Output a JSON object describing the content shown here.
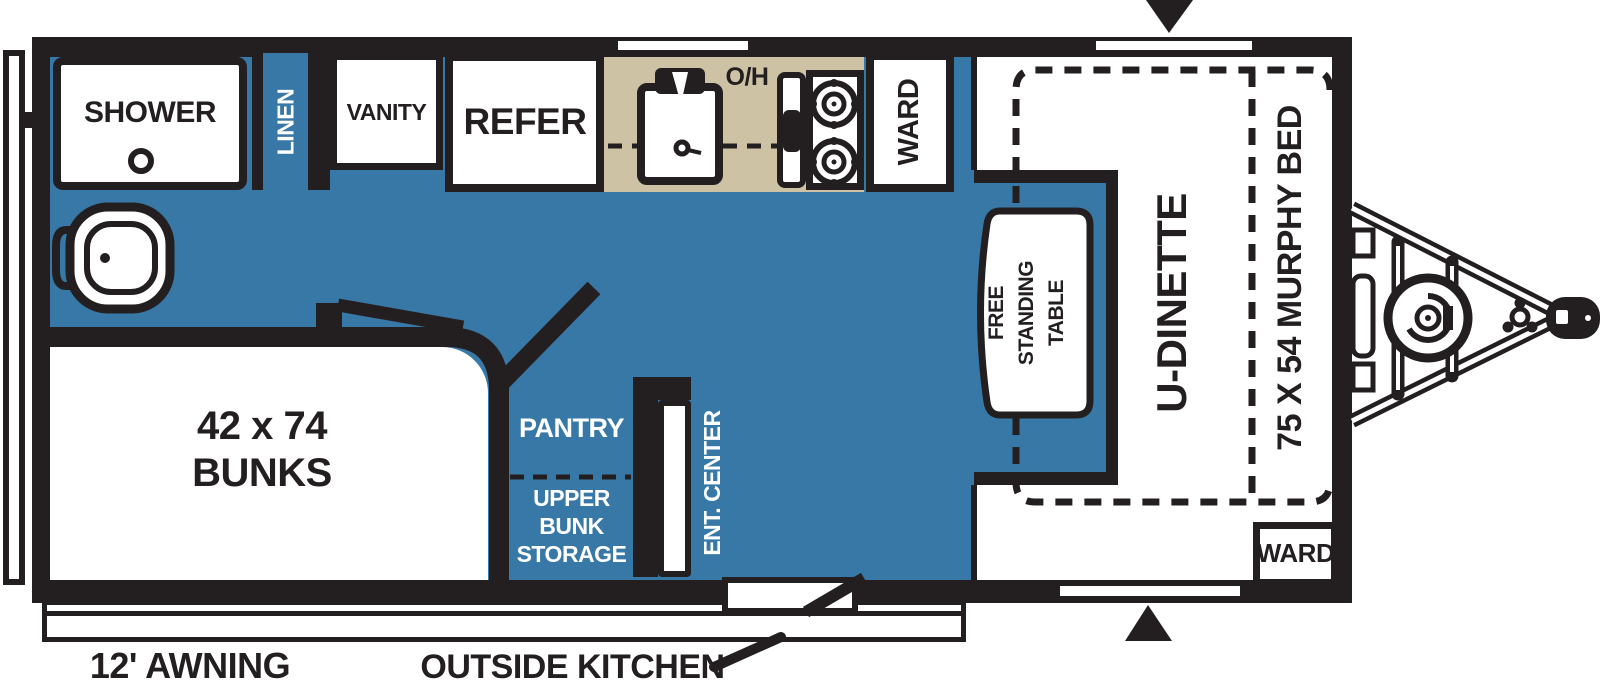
{
  "title": "Travel trailer floor plan",
  "colors": {
    "floor_blue": "#3878A6",
    "counter_tan": "#CEC2A5",
    "line_black": "#231F20",
    "white": "#FFFFFF"
  },
  "bathroom": {
    "shower": "SHOWER",
    "linen": "LINEN",
    "vanity": "VANITY"
  },
  "kitchen": {
    "refer": "REFER",
    "overhead": "O/H"
  },
  "storage": {
    "ward_top": "WARD",
    "ward_bottom": "WARD",
    "pantry": "PANTRY",
    "upper_bunk_storage": [
      "UPPER",
      "BUNK",
      "STORAGE"
    ],
    "ent_center": "ENT. CENTER"
  },
  "sleeping": {
    "bunks_line1": "42 x 74",
    "bunks_line2": "BUNKS",
    "murphy_bed": "75 X 54 MURPHY BED"
  },
  "dining": {
    "u_dinette": "U-DINETTE",
    "free_standing_table": [
      "FREE",
      "STANDING",
      "TABLE"
    ]
  },
  "exterior": {
    "awning": "12' AWNING",
    "outside_kitchen": "OUTSIDE KITCHEN"
  }
}
